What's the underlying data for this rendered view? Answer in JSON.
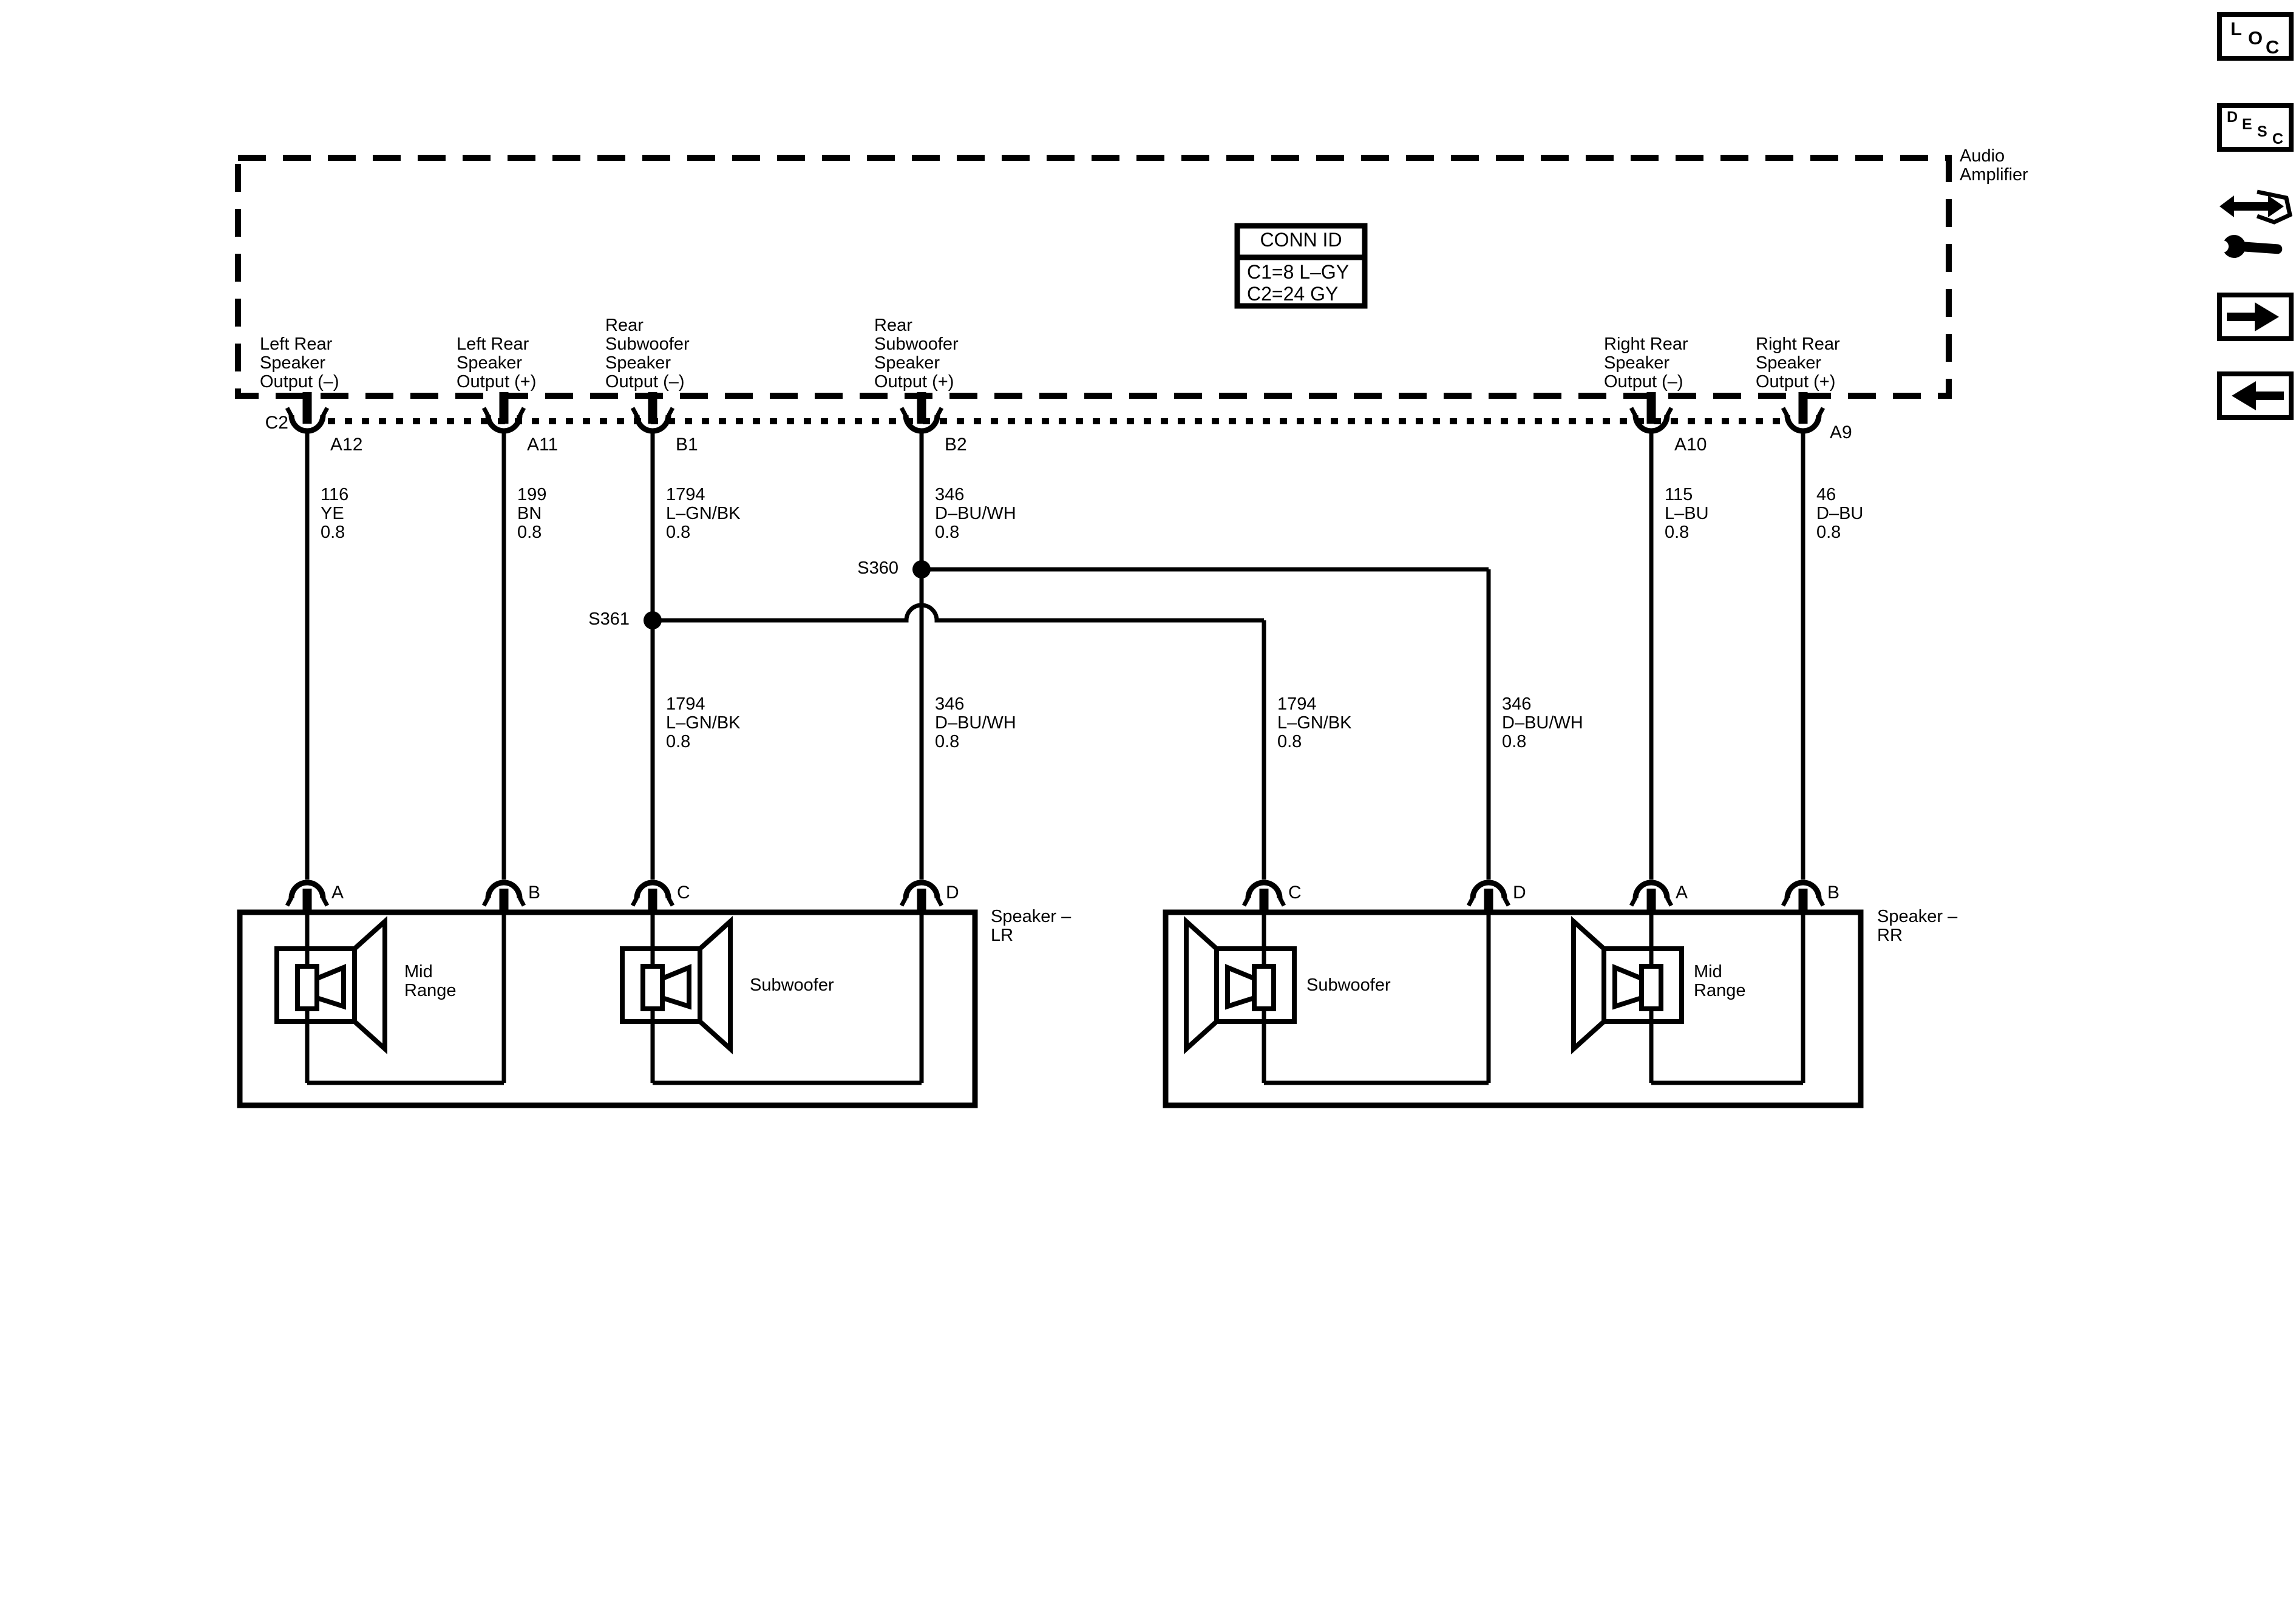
{
  "page": {
    "background": "#ffffff",
    "ink": "#000000"
  },
  "sidebar": {
    "loc_label": "LOC",
    "desc_label": "DESC",
    "tool_icon": "wiring-repair-tool-icon",
    "next_icon": "right-arrow",
    "back_icon": "left-arrow"
  },
  "amplifier": {
    "name": "Audio\nAmplifier",
    "connector_label": "C2",
    "conn_table": {
      "title": "CONN ID",
      "row1": "C1=8 L–GY",
      "row2": "C2=24 GY"
    }
  },
  "top_pins": {
    "a12": {
      "pin": "A12",
      "label": "Left Rear\nSpeaker\nOutput (–)"
    },
    "a11": {
      "pin": "A11",
      "label": "Left Rear\nSpeaker\nOutput (+)"
    },
    "b1": {
      "pin": "B1",
      "label": "Rear\nSubwoofer\nSpeaker\nOutput (–)"
    },
    "b2": {
      "pin": "B2",
      "label": "Rear\nSubwoofer\nSpeaker\nOutput (+)"
    },
    "a10": {
      "pin": "A10",
      "label": "Right Rear\nSpeaker\nOutput (–)"
    },
    "a9": {
      "pin": "A9",
      "label": "Right Rear\nSpeaker\nOutput (+)"
    }
  },
  "wire_specs": {
    "w1": "116\nYE\n0.8",
    "w2": "199\nBN\n0.8",
    "w3a": "1794\nL–GN/BK\n0.8",
    "w4a": "346\nD–BU/WH\n0.8",
    "w3b": "1794\nL–GN/BK\n0.8",
    "w4b": "346\nD–BU/WH\n0.8",
    "w5": "1794\nL–GN/BK\n0.8",
    "w6": "346\nD–BU/WH\n0.8",
    "w7": "115\nL–BU\n0.8",
    "w8": "46\nD–BU\n0.8"
  },
  "splices": {
    "s360": "S360",
    "s361": "S361"
  },
  "speaker_lr": {
    "label": "Speaker –\nLR",
    "pin_a": "A",
    "pin_b": "B",
    "pin_c": "C",
    "pin_d": "D",
    "midrange": "Mid\nRange",
    "subwoofer": "Subwoofer"
  },
  "speaker_rr": {
    "label": "Speaker –\nRR",
    "pin_c": "C",
    "pin_d": "D",
    "pin_a": "A",
    "pin_b": "B",
    "subwoofer": "Subwoofer",
    "midrange": "Mid\nRange"
  }
}
